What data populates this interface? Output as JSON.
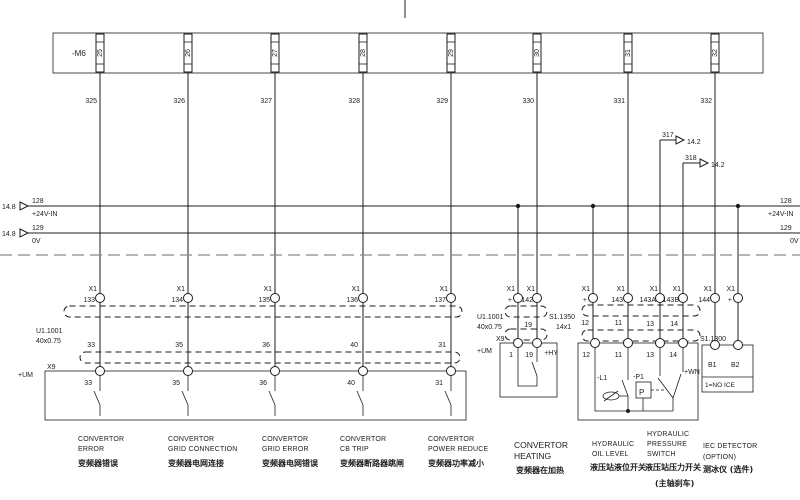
{
  "sheet": {
    "source_ref": "14.8",
    "dest_ref": "14.2"
  },
  "m6": {
    "label": "-M6",
    "terminals": [
      "25",
      "26",
      "27",
      "28",
      "29",
      "30",
      "31",
      "32"
    ],
    "wires": [
      "325",
      "326",
      "327",
      "328",
      "329",
      "330",
      "331",
      "332"
    ]
  },
  "bus": {
    "plus_num": "128",
    "plus_label": "+24V-IN",
    "zero_num": "129",
    "zero_label": "0V"
  },
  "refs": {
    "w317": "317",
    "w318": "318"
  },
  "x1": {
    "name": "X1",
    "pins": [
      "133",
      "134",
      "135",
      "136",
      "137",
      "+",
      "142",
      "+",
      "143",
      "143A",
      "143B",
      "144",
      "+"
    ]
  },
  "cables": {
    "u1": {
      "name": "U1.1001",
      "size": "40x0.75"
    },
    "s1350": {
      "name": "S1.1350",
      "size": "14x1"
    },
    "s1300": {
      "name": "S1.1300"
    }
  },
  "cores": {
    "left": [
      "33",
      "35",
      "36",
      "40",
      "31"
    ],
    "heat": "19",
    "hyd": [
      "12",
      "11",
      "13",
      "14"
    ]
  },
  "boxes": {
    "um": {
      "loc": "+UM",
      "conn": "X9",
      "pins": [
        "33",
        "35",
        "36",
        "40",
        "31"
      ]
    },
    "heat": {
      "loc": "+UM",
      "conn": "X9",
      "pins": [
        "1",
        "19"
      ]
    },
    "hyd": {
      "loc": "+HY",
      "pins": [
        "12",
        "11",
        "13",
        "14"
      ],
      "l1": "-L1",
      "p1": "-P1",
      "p": "P"
    },
    "ice": {
      "loc": "+WN",
      "pins": [
        "B1",
        "B2"
      ],
      "note": "1=NO ICE"
    }
  },
  "captions": [
    {
      "l1": "CONVERTOR",
      "l2": "ERROR",
      "l3": "",
      "zh": "变频器错误",
      "zh2": ""
    },
    {
      "l1": "CONVERTOR",
      "l2": "GRID CONNECTION",
      "l3": "",
      "zh": "变频器电网连接",
      "zh2": ""
    },
    {
      "l1": "CONVERTOR",
      "l2": "GRID ERROR",
      "l3": "",
      "zh": "变频器电网错误",
      "zh2": ""
    },
    {
      "l1": "CONVERTOR",
      "l2": "CB TRIP",
      "l3": "",
      "zh": "变频器断路器跳闸",
      "zh2": ""
    },
    {
      "l1": "CONVERTOR",
      "l2": "POWER REDUCE",
      "l3": "",
      "zh": "变频器功率减小",
      "zh2": ""
    },
    {
      "l1": "CONVERTOR",
      "l2": "HEATING",
      "l3": "",
      "zh": "变频器在加热",
      "zh2": ""
    },
    {
      "l1": "HYDRAULIC",
      "l2": "OIL LEVEL",
      "l3": "",
      "zh": "液压站液位开关",
      "zh2": ""
    },
    {
      "l1": "HYDRAULIC",
      "l2": "PRESSURE",
      "l3": "SWITCH",
      "zh": "液压站压力开关",
      "zh2": "(主轴刹车)"
    },
    {
      "l1": "IEC DETECTOR",
      "l2": "(OPTION)",
      "l3": "",
      "zh": "测冰仪 (选件)",
      "zh2": ""
    }
  ]
}
